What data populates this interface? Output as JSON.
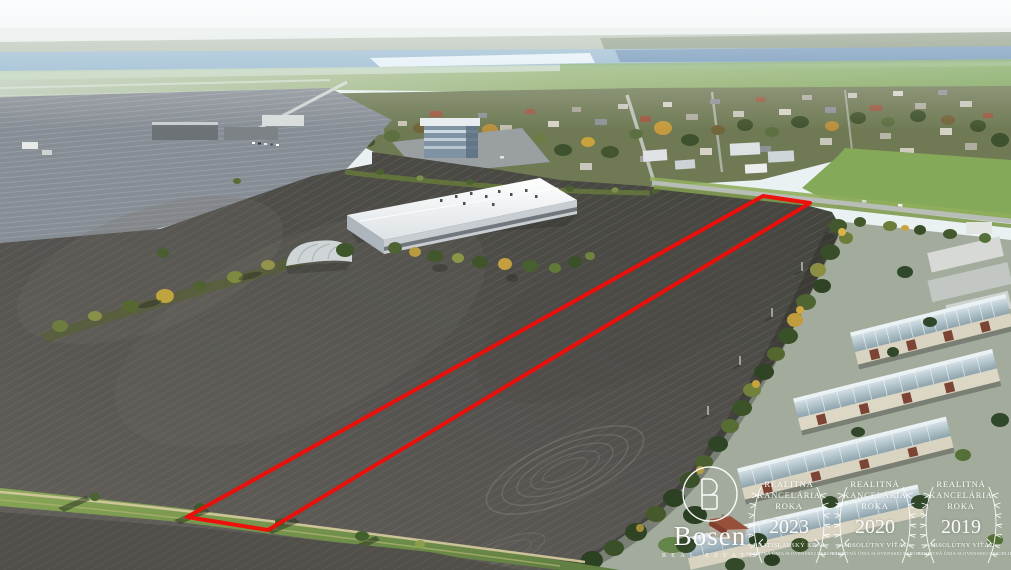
{
  "watermark": {
    "brand": "Bosen",
    "tagline": "REAL ESTATE",
    "color": "#ffffff",
    "awards": [
      {
        "title": [
          "REALITNÁ",
          "KANCELÁRIA",
          "ROKA"
        ],
        "year": "2023",
        "subtitle": "BRATISLAVSKÝ KRAJ",
        "fine_print": "REALITNÁ ÚNIA SLOVENSKEJ REPUBLIKY"
      },
      {
        "title": [
          "REALITNÁ",
          "KANCELÁRIA",
          "ROKA"
        ],
        "year": "2020",
        "subtitle": "ABSOLÚTNY VÍŤAZ",
        "fine_print": "REALITNÁ ÚNIA SLOVENSKEJ REPUBLIKY"
      },
      {
        "title": [
          "REALITNÁ",
          "KANCELÁRIA",
          "ROKA"
        ],
        "year": "2019",
        "subtitle": "ABSOLÚTNY VÍŤAZ",
        "fine_print": "REALITNÁ ÚNIA SLOVENSKEJ REPUBLIKY"
      }
    ]
  },
  "annotation": {
    "property_boundary_color": "#ee0d08"
  }
}
